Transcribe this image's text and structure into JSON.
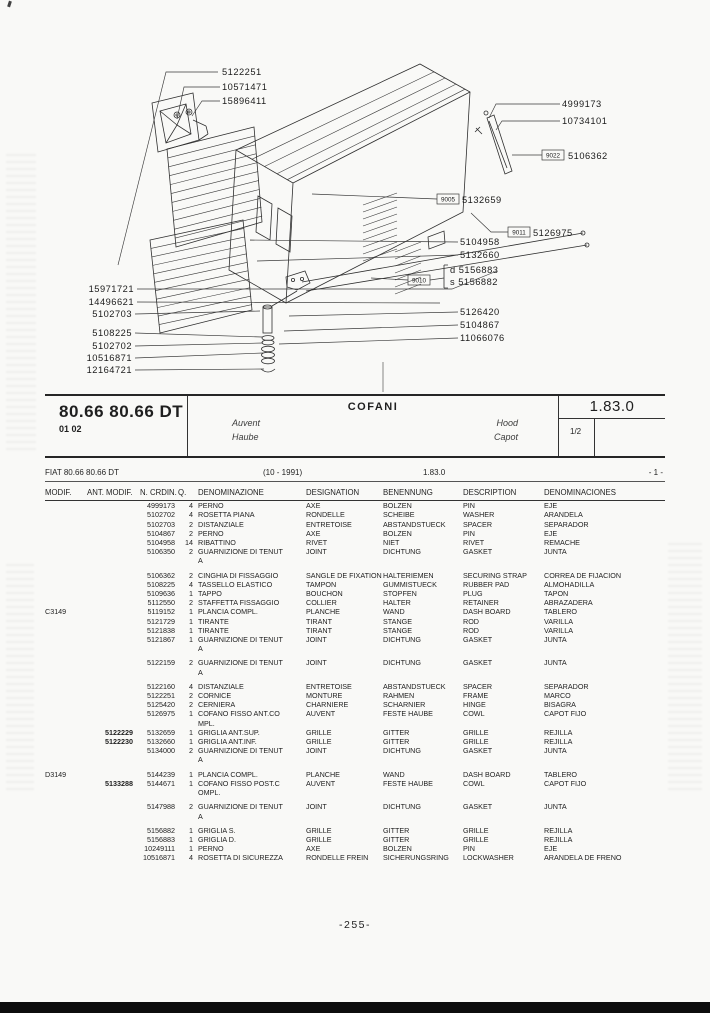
{
  "header": {
    "model": "80.66 80.66 DT",
    "code": "01 02",
    "title": "COFANI",
    "lang_labels": {
      "fr": "Auvent",
      "de": "Haube",
      "en": "Hood",
      "es": "Capot"
    },
    "section": "1.83.0",
    "sheet": "1/2"
  },
  "subheader": {
    "model_line": "FIAT 80.66 80.66 DT",
    "period": "(10 - 1991)",
    "section": "1.83.0",
    "index": "- 1 -"
  },
  "footer": {
    "page_number": "-255-"
  },
  "diagram": {
    "callouts": [
      {
        "code": "5122251"
      },
      {
        "code": "10571471"
      },
      {
        "code": "15896411"
      },
      {
        "code": "4999173"
      },
      {
        "code": "10734101"
      },
      {
        "box": "9022",
        "code": "5106362"
      },
      {
        "box": "9005",
        "code": "5132659"
      },
      {
        "box": "9011",
        "code": "5126975"
      },
      {
        "code": "5104958"
      },
      {
        "code": "5132660"
      },
      {
        "box": "9010",
        "code": ""
      },
      {
        "prefix": "d",
        "code": "5156883"
      },
      {
        "prefix": "s",
        "code": "5156882"
      },
      {
        "code": "5126420"
      },
      {
        "code": "5104867"
      },
      {
        "code": "11066076"
      },
      {
        "code": "15971721"
      },
      {
        "code": "14496621"
      },
      {
        "code": "5102703"
      },
      {
        "code": "5108225"
      },
      {
        "code": "5102702"
      },
      {
        "code": "10516871"
      },
      {
        "code": "12164721"
      }
    ]
  },
  "table": {
    "columns": [
      "MODIF.",
      "ANT. MODIF.",
      "N. CRDIN.",
      "Q.",
      "DENOMINAZIONE",
      "DESIGNATION",
      "BENENNUNG",
      "DESCRIPTION",
      "DENOMINACIONES"
    ],
    "rows": [
      {
        "modif": "",
        "ant": "",
        "n": "4999173",
        "q": "4",
        "it": "PERNO",
        "fr": "AXE",
        "de": "BOLZEN",
        "en": "PIN",
        "es": "EJE",
        "gap": false
      },
      {
        "modif": "",
        "ant": "",
        "n": "5102702",
        "q": "4",
        "it": "ROSETTA PIANA",
        "fr": "RONDELLE",
        "de": "SCHEIBE",
        "en": "WASHER",
        "es": "ARANDELA",
        "gap": false
      },
      {
        "modif": "",
        "ant": "",
        "n": "5102703",
        "q": "2",
        "it": "DISTANZIALE",
        "fr": "ENTRETOISE",
        "de": "ABSTANDSTUECK",
        "en": "SPACER",
        "es": "SEPARADOR",
        "gap": false
      },
      {
        "modif": "",
        "ant": "",
        "n": "5104867",
        "q": "2",
        "it": "PERNO",
        "fr": "AXE",
        "de": "BOLZEN",
        "en": "PIN",
        "es": "EJE",
        "gap": false
      },
      {
        "modif": "",
        "ant": "",
        "n": "5104958",
        "q": "14",
        "it": "RIBATTINO",
        "fr": "RIVET",
        "de": "NIET",
        "en": "RIVET",
        "es": "REMACHE",
        "gap": false
      },
      {
        "modif": "",
        "ant": "",
        "n": "5106350",
        "q": "2",
        "it": "GUARNIZIONE DI TENUT\nA",
        "fr": "JOINT",
        "de": "DICHTUNG",
        "en": "GASKET",
        "es": "JUNTA",
        "gap": false
      },
      {
        "modif": "",
        "ant": "",
        "n": "5106362",
        "q": "2",
        "it": "CINGHIA DI FISSAGGIO",
        "fr": "SANGLE DE FIXATION",
        "de": "HALTERIEMEN",
        "en": "SECURING STRAP",
        "es": "CORREA DE FIJACION",
        "gap": true
      },
      {
        "modif": "",
        "ant": "",
        "n": "5108225",
        "q": "4",
        "it": "TASSELLO ELASTICO",
        "fr": "TAMPON",
        "de": "GUMMISTUECK",
        "en": "RUBBER PAD",
        "es": "ALMOHADILLA",
        "gap": false
      },
      {
        "modif": "",
        "ant": "",
        "n": "5109636",
        "q": "1",
        "it": "TAPPO",
        "fr": "BOUCHON",
        "de": "STOPFEN",
        "en": "PLUG",
        "es": "TAPON",
        "gap": false
      },
      {
        "modif": "",
        "ant": "",
        "n": "5112550",
        "q": "2",
        "it": "STAFFETTA FISSAGGIO",
        "fr": "COLLIER",
        "de": "HALTER",
        "en": "RETAINER",
        "es": "ABRAZADERA",
        "gap": false
      },
      {
        "modif": "C3149",
        "ant": "",
        "n": "5119152",
        "q": "1",
        "it": "PLANCIA COMPL.",
        "fr": "PLANCHE",
        "de": "WAND",
        "en": "DASH BOARD",
        "es": "TABLERO",
        "gap": false
      },
      {
        "modif": "",
        "ant": "",
        "n": "5121729",
        "q": "1",
        "it": "TIRANTE",
        "fr": "TIRANT",
        "de": "STANGE",
        "en": "ROD",
        "es": "VARILLA",
        "gap": false
      },
      {
        "modif": "",
        "ant": "",
        "n": "5121838",
        "q": "1",
        "it": "TIRANTE",
        "fr": "TIRANT",
        "de": "STANGE",
        "en": "ROD",
        "es": "VARILLA",
        "gap": false
      },
      {
        "modif": "",
        "ant": "",
        "n": "5121867",
        "q": "1",
        "it": "GUARNIZIONE DI TENUT\nA",
        "fr": "JOINT",
        "de": "DICHTUNG",
        "en": "GASKET",
        "es": "JUNTA",
        "gap": false
      },
      {
        "modif": "",
        "ant": "",
        "n": "5122159",
        "q": "2",
        "it": "GUARNIZIONE DI TENUT\nA",
        "fr": "JOINT",
        "de": "DICHTUNG",
        "en": "GASKET",
        "es": "JUNTA",
        "gap": true
      },
      {
        "modif": "",
        "ant": "",
        "n": "5122160",
        "q": "4",
        "it": "DISTANZIALE",
        "fr": "ENTRETOISE",
        "de": "ABSTANDSTUECK",
        "en": "SPACER",
        "es": "SEPARADOR",
        "gap": true
      },
      {
        "modif": "",
        "ant": "",
        "n": "5122251",
        "q": "2",
        "it": "CORNICE",
        "fr": "MONTURE",
        "de": "RAHMEN",
        "en": "FRAME",
        "es": "MARCO",
        "gap": false
      },
      {
        "modif": "",
        "ant": "",
        "n": "5125420",
        "q": "2",
        "it": "CERNIERA",
        "fr": "CHARNIERE",
        "de": "SCHARNIER",
        "en": "HINGE",
        "es": "BISAGRA",
        "gap": false
      },
      {
        "modif": "",
        "ant": "",
        "n": "5126975",
        "q": "1",
        "it": "COFANO FISSO  ANT.CO\nMPL.",
        "fr": "AUVENT",
        "de": "FESTE HAUBE",
        "en": "COWL",
        "es": "CAPOT FIJO",
        "gap": false
      },
      {
        "modif": "",
        "ant": "5122229",
        "n": "5132659",
        "q": "1",
        "it": "GRIGLIA  ANT.SUP.",
        "fr": "GRILLE",
        "de": "GITTER",
        "en": "GRILLE",
        "es": "REJILLA",
        "gap": false
      },
      {
        "modif": "",
        "ant": "5122230",
        "n": "5132660",
        "q": "1",
        "it": "GRIGLIA  ANT.INF.",
        "fr": "GRILLE",
        "de": "GITTER",
        "en": "GRILLE",
        "es": "REJILLA",
        "gap": false
      },
      {
        "modif": "",
        "ant": "",
        "n": "5134000",
        "q": "2",
        "it": "GUARNIZIONE DI TENUT\nA",
        "fr": "JOINT",
        "de": "DICHTUNG",
        "en": "GASKET",
        "es": "JUNTA",
        "gap": false
      },
      {
        "modif": "D3149",
        "ant": "",
        "n": "5144239",
        "q": "1",
        "it": "PLANCIA COMPL.",
        "fr": "PLANCHE",
        "de": "WAND",
        "en": "DASH BOARD",
        "es": "TABLERO",
        "gap": true
      },
      {
        "modif": "",
        "ant": "5133288",
        "n": "5144671",
        "q": "1",
        "it": "COFANO FISSO  POST.C\nOMPL.",
        "fr": "AUVENT",
        "de": "FESTE HAUBE",
        "en": "COWL",
        "es": "CAPOT FIJO",
        "gap": false
      },
      {
        "modif": "",
        "ant": "",
        "n": "5147988",
        "q": "2",
        "it": "GUARNIZIONE DI TENUT\nA",
        "fr": "JOINT",
        "de": "DICHTUNG",
        "en": "GASKET",
        "es": "JUNTA",
        "gap": true
      },
      {
        "modif": "",
        "ant": "",
        "n": "5156882",
        "q": "1",
        "it": "GRIGLIA S.",
        "fr": "GRILLE",
        "de": "GITTER",
        "en": "GRILLE",
        "es": "REJILLA",
        "gap": true
      },
      {
        "modif": "",
        "ant": "",
        "n": "5156883",
        "q": "1",
        "it": "GRIGLIA D.",
        "fr": "GRILLE",
        "de": "GITTER",
        "en": "GRILLE",
        "es": "REJILLA",
        "gap": false
      },
      {
        "modif": "",
        "ant": "",
        "n": "10249111",
        "q": "1",
        "it": "PERNO",
        "fr": "AXE",
        "de": "BOLZEN",
        "en": "PIN",
        "es": "EJE",
        "gap": false
      },
      {
        "modif": "",
        "ant": "",
        "n": "10516871",
        "q": "4",
        "it": "ROSETTA DI SICUREZZA",
        "fr": "RONDELLE FREIN",
        "de": "SICHERUNGSRING",
        "en": "LOCKWASHER",
        "es": "ARANDELA DE FRENO",
        "gap": false
      }
    ]
  }
}
